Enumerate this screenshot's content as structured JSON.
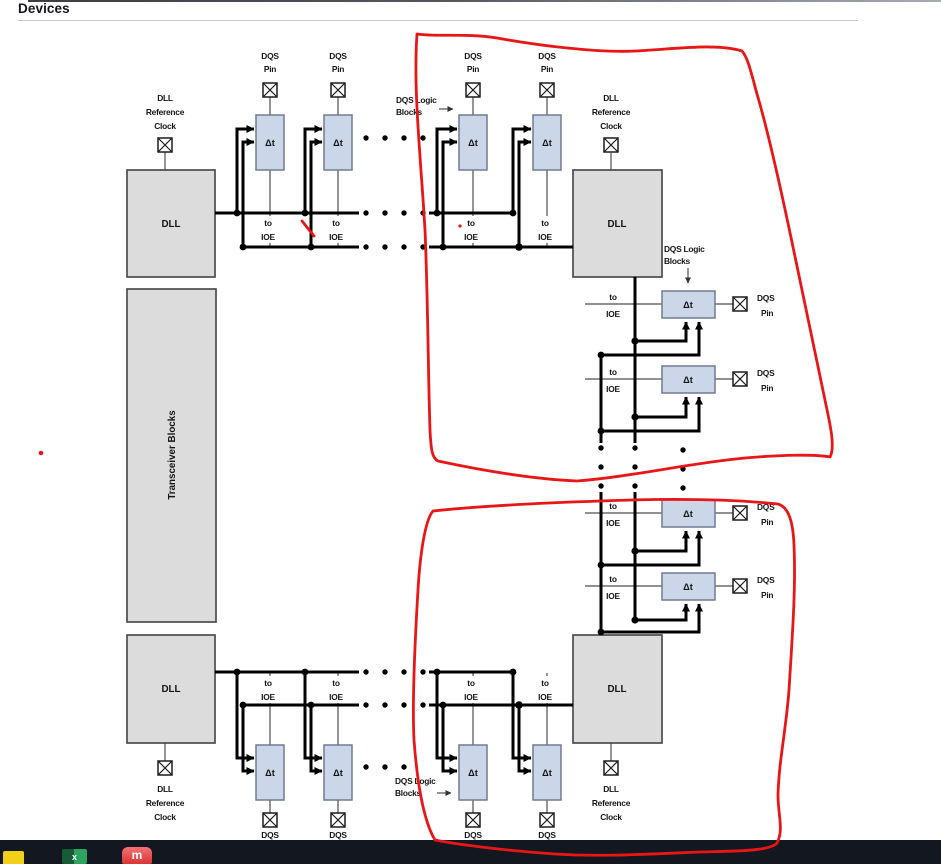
{
  "header": {
    "title": "Devices"
  },
  "diagram": {
    "labels": {
      "dqs": "DQS",
      "pin": "Pin",
      "to": "to",
      "ioe": "IOE",
      "delay": "Δt",
      "dll": "DLL",
      "reference": "Reference",
      "clock": "Clock",
      "dqs_logic": "DQS Logic",
      "blocks": "Blocks",
      "transceiver_blocks": "Transceiver Blocks"
    },
    "colors": {
      "annotation_red": "#e81616",
      "block_gray": "#dcdcdc",
      "delay_fill": "#ccd6e9",
      "taskbar_bg": "#131720"
    }
  },
  "taskbar": {
    "icons": [
      {
        "name": "folder-icon"
      },
      {
        "name": "excel-icon",
        "glyph": "x"
      },
      {
        "name": "media-app-icon",
        "glyph": "m"
      }
    ]
  }
}
